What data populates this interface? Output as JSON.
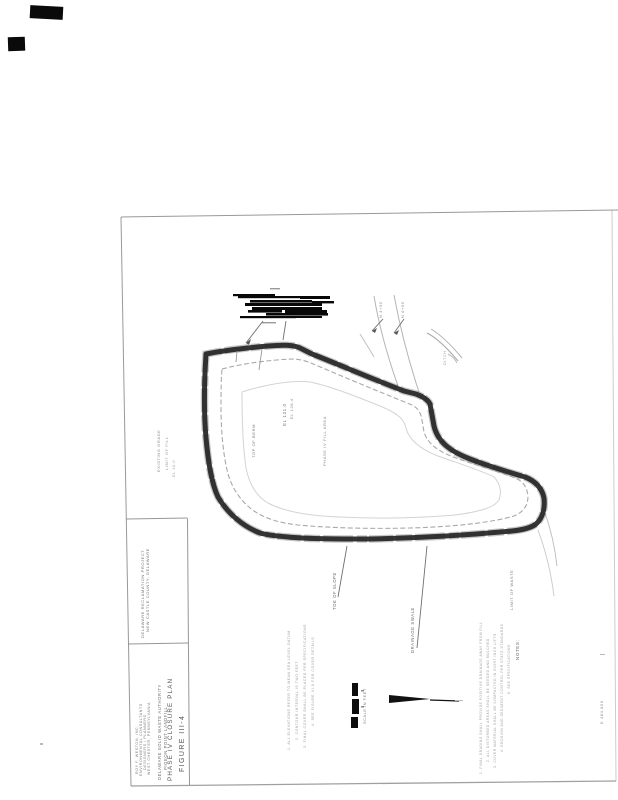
{
  "document": {
    "type_note": "scanned engineering drawing, rotated 90 degrees",
    "figure_label": "FIGURE III-4",
    "drawing_title": "PHASE IV CLOSURE PLAN"
  },
  "title_block": {
    "figure_label": "FIGURE III-4",
    "drawing_title": "PHASE IV CLOSURE PLAN",
    "org_line1": "DELAWARE SOLID WASTE AUTHORITY",
    "org_line2": "PIGEON POINT LANDFILL",
    "firm_line1": "ROY F. WESTON, INC.",
    "firm_line2": "ENVIRONMENTAL CONSULTANTS",
    "firm_line3": "DESIGNERS / PLANNERS",
    "firm_line4": "WEST CHESTER, PENNSYLVANIA",
    "upper_cell_line1": "DELAWARE RECLAMATION PROJECT",
    "upper_cell_line2": "NEW CASTLE COUNTY, DELAWARE"
  },
  "map": {
    "labels": [
      {
        "text": "EL 131.0"
      },
      {
        "text": "EL 128.4"
      },
      {
        "text": "TOP OF BERM"
      },
      {
        "text": "PHASE IV FILL AREA"
      },
      {
        "text": "EXISTING GRADE"
      },
      {
        "text": "LIMIT OF FILL"
      },
      {
        "text": "EL 10.0"
      },
      {
        "text": "N 4+00"
      },
      {
        "text": "N 6+00"
      },
      {
        "text": "DITCH"
      },
      {
        "text": "TOE OF SLOPE"
      },
      {
        "text": "DRAINAGE SWALE"
      },
      {
        "text": "LIMIT OF WASTE"
      },
      {
        "text": "SCALE IN FEET"
      },
      {
        "text": "E 484,500"
      }
    ],
    "notes_left": [
      {
        "text": "1. ALL ELEVATIONS REFER TO MEAN SEA LEVEL DATUM"
      },
      {
        "text": "2. CONTOUR INTERVAL IS TWO FEET"
      },
      {
        "text": "3. FINAL COVER SHALL BE PLACED PER SPECIFICATIONS"
      },
      {
        "text": "4. SEE FIGURE III-5 FOR COVER DETAILS"
      }
    ],
    "notes_right_header": "NOTES:",
    "notes_right": [
      {
        "text": "1. FINAL GRADING SHALL PROVIDE POSITIVE DRAINAGE AWAY FROM FILL"
      },
      {
        "text": "2. ALL DISTURBED AREAS SHALL BE SEEDED AND MULCHED"
      },
      {
        "text": "3. COVER MATERIAL SHALL BE COMPACTED IN EIGHT INCH LIFTS"
      },
      {
        "text": "4. EROSION AND SEDIMENT CONTROL PER STATE STANDARDS"
      },
      {
        "text": "5. SEE SPECIFICATIONS"
      }
    ]
  },
  "colors": {
    "ink": "#242424",
    "border": "#808080",
    "contour": "#9a9a9a",
    "faint": "#bdbdbd",
    "tiny_text": "#6e6e6e"
  }
}
